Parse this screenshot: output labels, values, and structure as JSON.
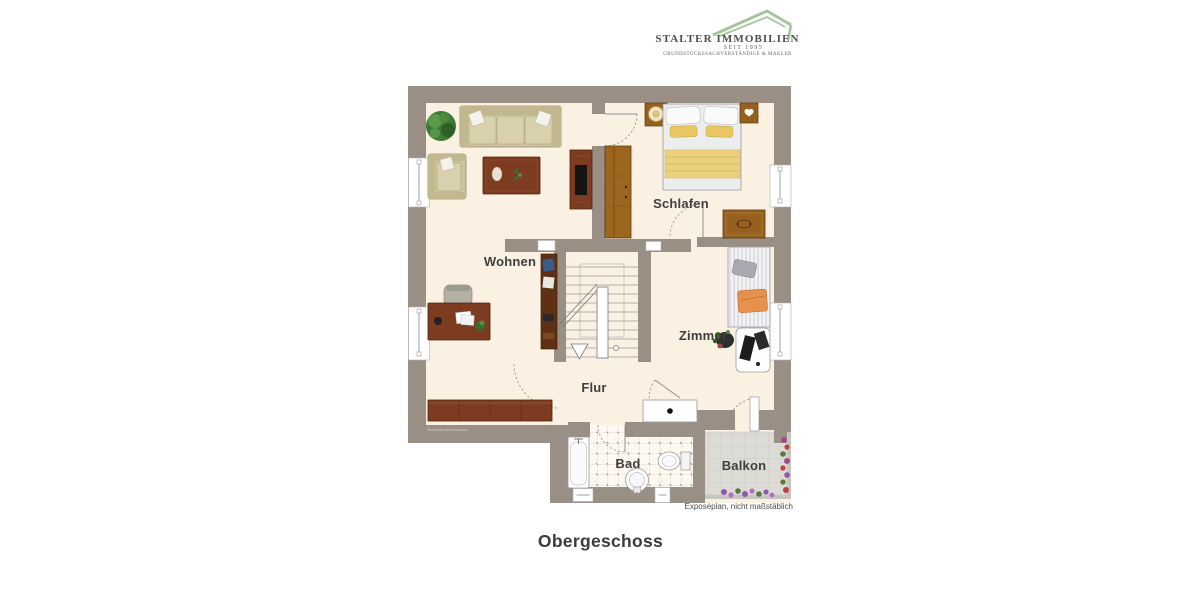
{
  "logo": {
    "name_display": "STALTER IMMOBILIEN",
    "tagline": "SEIT 1995",
    "subtitle": "GRUNDSTÜCKSSACHVERSTÄNDIGE & MAKLER"
  },
  "plan": {
    "labels": {
      "wohnen": "Wohnen",
      "schlafen": "Schlafen",
      "zimmer": "Zimmer",
      "flur": "Flur",
      "bad": "Bad",
      "balkon": "Balkon"
    },
    "watermark": "Illustration@immocado",
    "note": "Exposéplan, nicht maßstäblich"
  },
  "title": "Obergeschoss",
  "colors": {
    "wall": "#9a8f85",
    "floor": "#fbf1e2",
    "logo_green": "#a7c59c",
    "label": "#3f3f3f"
  }
}
